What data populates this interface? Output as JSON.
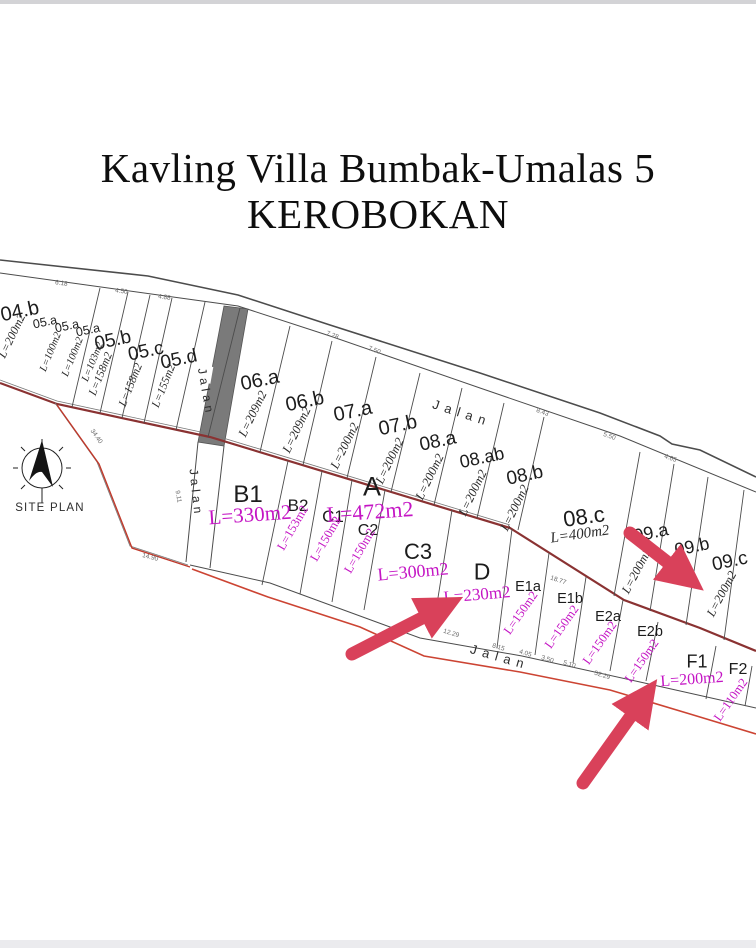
{
  "title": {
    "line1": "Kavling Villa Bumbak-Umalas 5",
    "line2": "KEROBOKAN"
  },
  "site_plan_label": "SITE PLAN",
  "road_labels": {
    "top": "Jalan",
    "mid_upper": "Jalan",
    "mid_lower": "Jalan",
    "bottom": "Jalan"
  },
  "plots_top": [
    {
      "id": "04.b",
      "area": "L=200m2"
    },
    {
      "id": "05.a",
      "area": "L=100m2"
    },
    {
      "id": "05.a",
      "area": "L=100m2"
    },
    {
      "id": "05.a",
      "area": "L=103m2"
    },
    {
      "id": "05.b",
      "area": "L=158m2"
    },
    {
      "id": "05.c",
      "area": "L=158m2"
    },
    {
      "id": "05.d",
      "area": "L=155m2"
    },
    {
      "id": "06.a",
      "area": "L=209m2"
    },
    {
      "id": "06.b",
      "area": "L=209m2"
    },
    {
      "id": "07.a",
      "area": "L=200m2"
    },
    {
      "id": "07.b",
      "area": "L=200m2"
    },
    {
      "id": "08.a",
      "area": "L=200m2"
    },
    {
      "id": "08.ab",
      "area": "L=200m2"
    },
    {
      "id": "08.b",
      "area": "L=200m2"
    },
    {
      "id": "08.c",
      "area": "L=400m2"
    },
    {
      "id": "09.a",
      "area": "L=200m2"
    },
    {
      "id": "09.b",
      "area": ""
    },
    {
      "id": "09.c",
      "area": "L=200m2"
    }
  ],
  "plots_bottom": [
    {
      "id": "A",
      "area": "L=472m2"
    },
    {
      "id": "B1",
      "area": "L=330m2"
    },
    {
      "id": "B2",
      "area": "L=153m2"
    },
    {
      "id": "C1",
      "area": "L=150m2"
    },
    {
      "id": "C2",
      "area": "L=150m2"
    },
    {
      "id": "C3",
      "area": "L=300m2"
    },
    {
      "id": "D",
      "area": "L=230m2"
    },
    {
      "id": "E1a",
      "area": "L=150m2"
    },
    {
      "id": "E1b",
      "area": "L=150m2"
    },
    {
      "id": "E2a",
      "area": "L=150m2"
    },
    {
      "id": "E2b",
      "area": "L=150m2"
    },
    {
      "id": "F1",
      "area": "L=200m2"
    },
    {
      "id": "F2",
      "area": "L=110m2"
    }
  ],
  "dimensions": [
    "6.18",
    "4.50",
    "4.88",
    "7.28",
    "7.50",
    "8.43",
    "5.50",
    "4.65",
    "9.11",
    "34.40",
    "14.90",
    "12.29",
    "8.15",
    "4.05",
    "3.50",
    "5.10",
    "18.77",
    "52.29"
  ],
  "colors": {
    "area_highlight": "#c414c4",
    "arrow": "#d9415a",
    "parcel_boundary": "#8a3232",
    "road_edge_red": "#cc4433"
  }
}
